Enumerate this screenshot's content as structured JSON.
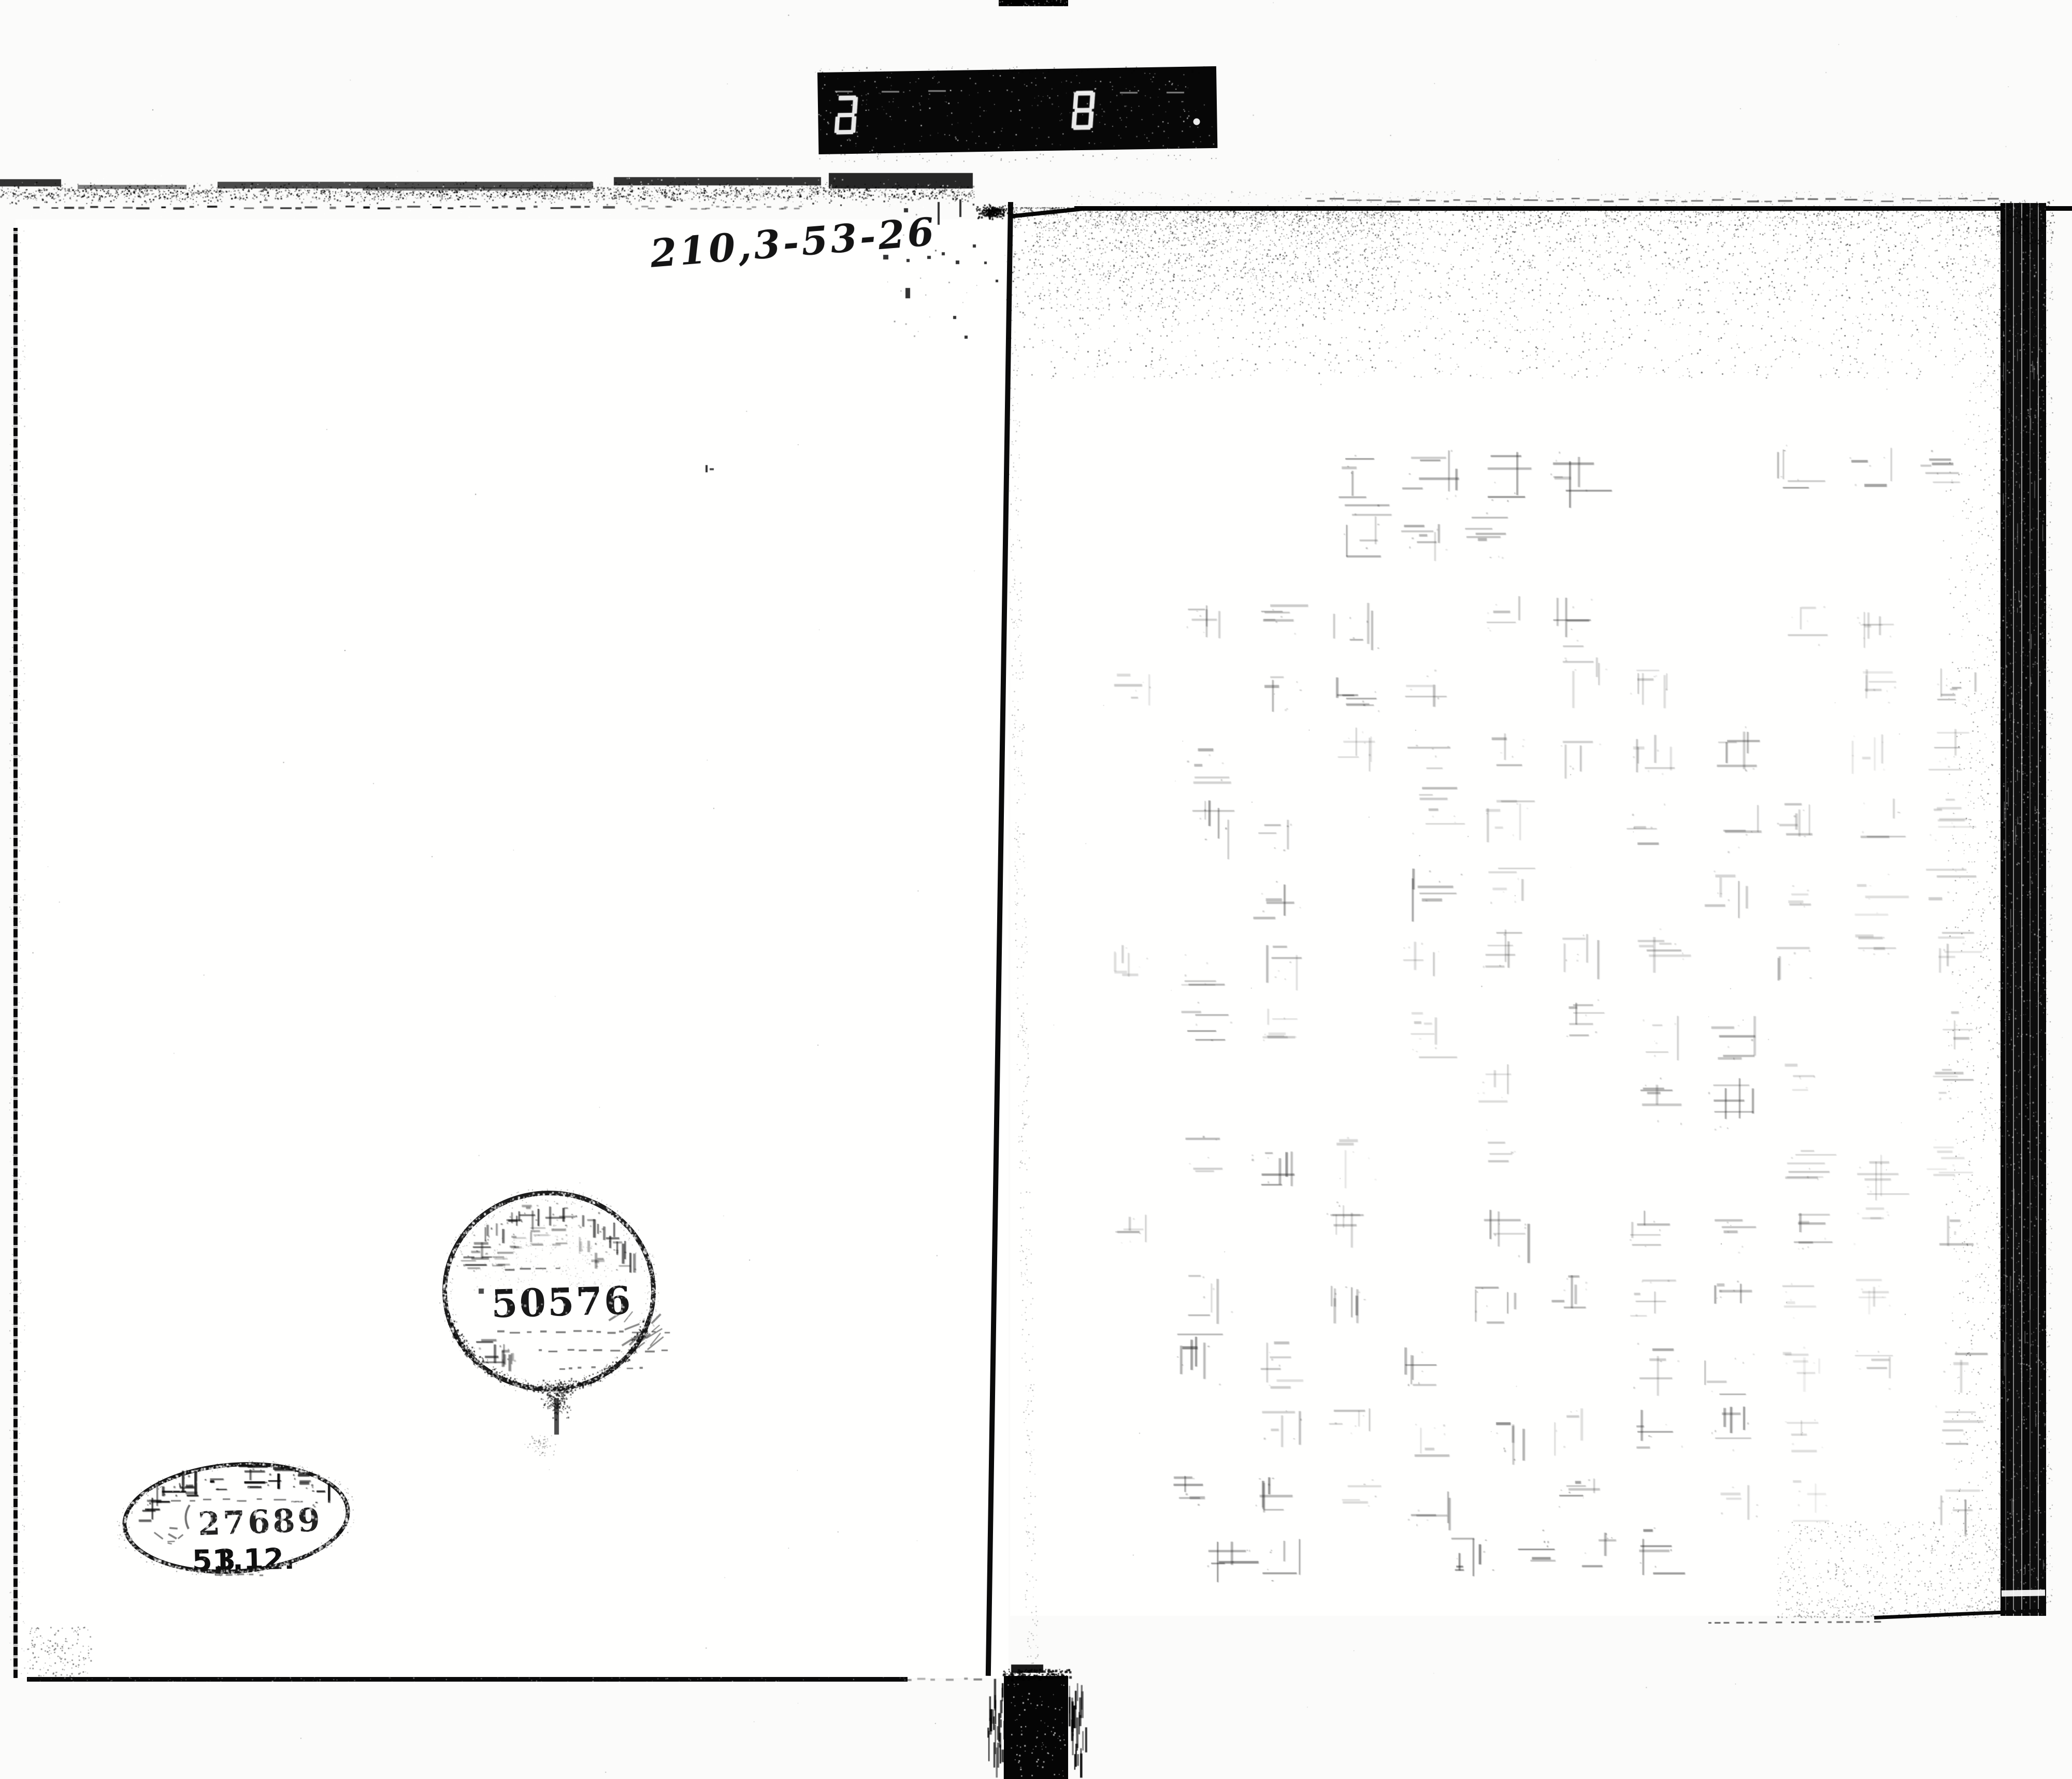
{
  "frame": {
    "counter": {
      "group1": "727",
      "group2": "328",
      "decimal_point": "."
    },
    "call_number": "210,3-53-26"
  },
  "stamps": {
    "circular": {
      "number": "50576",
      "shape": "circle",
      "arc_text_note": "illegible faded ring text and inner marks"
    },
    "oval": {
      "number": "27689",
      "date_prefix": "51.12.",
      "date_day": "3",
      "shape": "oval",
      "arc_text_note": "degraded kanji institution name along upper arc (8 characters, illegible)"
    }
  },
  "left_page": {
    "content_note": "blank scanned page"
  },
  "right_page": {
    "content_note": "faint illegible bleed-through text in vertical columns",
    "columns": 11,
    "approx_rows": 15
  }
}
